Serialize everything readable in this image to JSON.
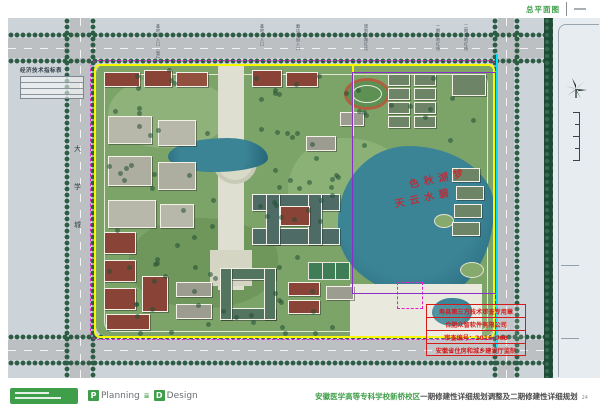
{
  "sheet": {
    "title": "总平面图"
  },
  "map": {
    "indicator_table_title": "经济技术指标表",
    "left_road_chars": [
      "大",
      "学",
      "城"
    ],
    "top_labels": [
      "基地主入口（暂行）",
      "基地次入口",
      "磨店家园入口",
      "规划道路红线",
      "一期用地红线",
      "二期用地红线"
    ],
    "lake_watermark": [
      "梦湖秋色",
      "碧水云天"
    ],
    "stamp_lines": [
      "寿县第三方技术审查专用章",
      "合肥众智软件有限公司",
      "审查编号：2016-008",
      "安徽省住房和城乡建设厅监制"
    ],
    "colors": {
      "site_boundary": "#f8f800",
      "phase_boundary": "#8a30c8",
      "red_line": "#e51fd0",
      "blue_line": "#00e0ff",
      "water": "#2f7b8a",
      "stamp_red": "#d41c1c"
    }
  },
  "footer": {
    "brand_word1": "Planning",
    "brand_word2": "Design",
    "brand_separator": "≣",
    "project_name": "安徽医学高等专科学校新桥校区",
    "project_subtitle": "一期修建性详细规划调整及二期修建性详细规划",
    "page_number": "24"
  }
}
